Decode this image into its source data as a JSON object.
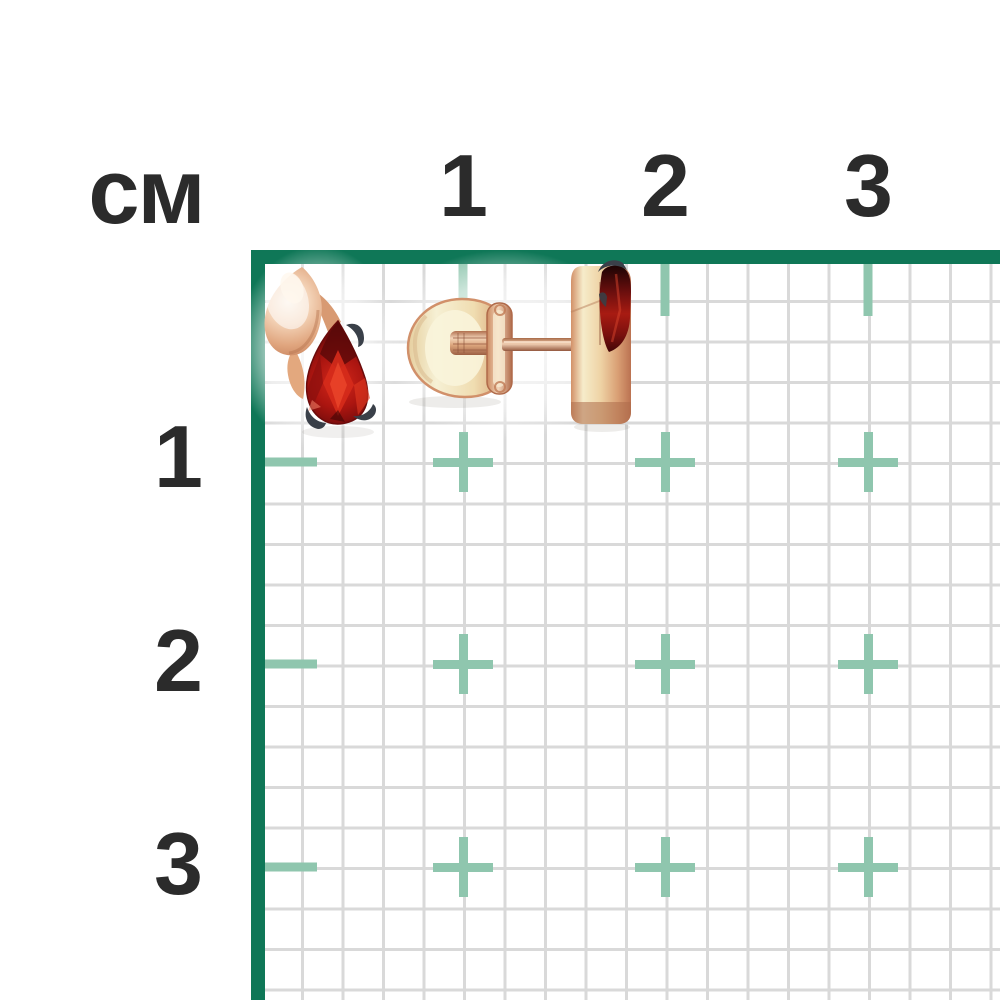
{
  "colors": {
    "page-bg": "#ffffff",
    "border-green": "#0f7757",
    "tick-teal": "#8fc6ae",
    "grid-line": "#d9d9d9",
    "label-ink": "#2b2b2b",
    "rose-gold-light": "#f7e7d4",
    "rose-gold-mid": "#e2a87f",
    "rose-gold-deep": "#c07a55",
    "pale-gold": "#f5eecb",
    "garnet-bright": "#c92015",
    "garnet-mid": "#9c1210",
    "garnet-dark": "#4e0707",
    "prong-metal": "#343940"
  },
  "ruler": {
    "unit_label": "см",
    "top_ticks": [
      {
        "label": "1"
      },
      {
        "label": "2"
      },
      {
        "label": "3"
      }
    ],
    "left_ticks": [
      {
        "label": "1"
      },
      {
        "label": "2"
      },
      {
        "label": "3"
      }
    ]
  },
  "product": {
    "description": "pair-of-rose-gold-stud-earrings-with-pear-cut-dark-red-gemstones",
    "views": [
      {
        "name": "front-view-earring",
        "parts": [
          "polished-gold-teardrop",
          "pear-cut-red-gemstone",
          "dark-prong-claws"
        ]
      },
      {
        "name": "side-view-earring",
        "parts": [
          "screw-back-clasp",
          "threaded-ear-post",
          "gold-mount-profile",
          "red-gemstone-profile",
          "dark-prong-claw"
        ]
      }
    ]
  }
}
